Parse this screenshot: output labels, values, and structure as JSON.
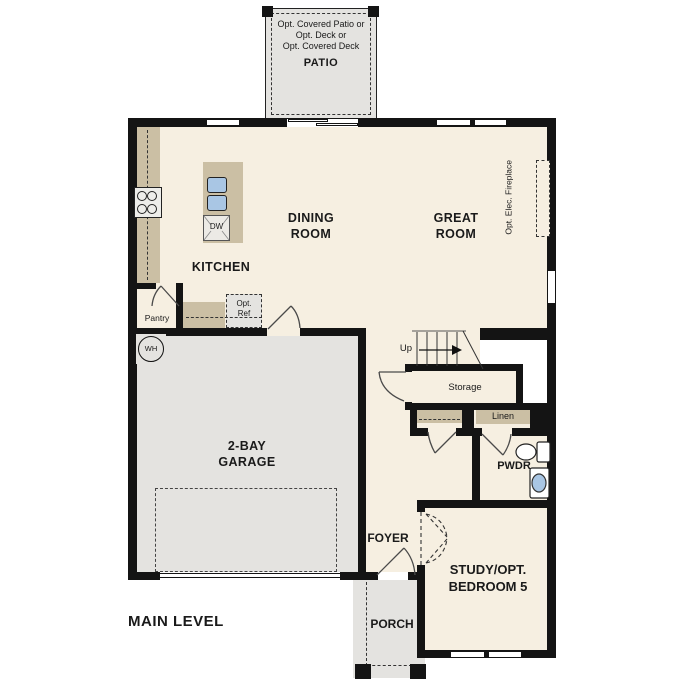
{
  "plan": {
    "title": "MAIN LEVEL",
    "patio": {
      "opt_line1": "Opt. Covered Patio or",
      "opt_line2": "Opt. Deck or",
      "opt_line3": "Opt. Covered Deck",
      "label": "PATIO"
    },
    "dining_room": {
      "line1": "DINING",
      "line2": "ROOM"
    },
    "great_room": {
      "line1": "GREAT",
      "line2": "ROOM"
    },
    "kitchen": {
      "label": "KITCHEN",
      "dishwasher": "DW",
      "pantry": "Pantry",
      "opt_ref_line1": "Opt.",
      "opt_ref_line2": "Ref"
    },
    "utility": {
      "water_heater": "WH"
    },
    "garage": {
      "line1": "2-BAY",
      "line2": "GARAGE"
    },
    "stairs": {
      "up": "Up"
    },
    "storage": {
      "label": "Storage"
    },
    "linen": {
      "label": "Linen"
    },
    "powder": {
      "label": "PWDR"
    },
    "foyer": {
      "label": "FOYER"
    },
    "porch": {
      "label": "PORCH"
    },
    "study": {
      "line1": "STUDY/OPT.",
      "line2": "BEDROOM 5"
    },
    "fireplace": {
      "label": "Opt. Elec. Fireplace"
    }
  },
  "colors": {
    "floor": "#f6efe1",
    "concrete": "#e4e3e0",
    "counter": "#cbbfa4",
    "fixture_blue": "#a9c6e4",
    "wall": "#141414"
  }
}
